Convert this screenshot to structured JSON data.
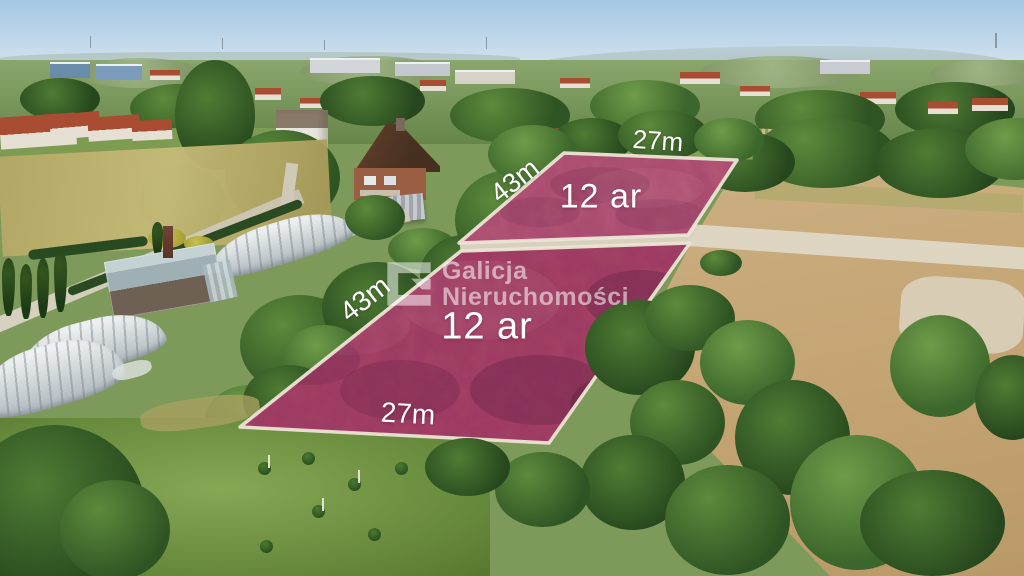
{
  "scene": {
    "description": "Aerial drone photo of two adjacent building plots for sale, highlighted in raspberry-pink with white survey borders, set in a suburban landscape with houses, greenhouses, trees and dry stubble fields",
    "language": "pl"
  },
  "plots": [
    {
      "id": "upper",
      "area_label": "12 ar",
      "front_label": "27m",
      "side_label": "43m"
    },
    {
      "id": "lower",
      "area_label": "12 ar",
      "front_label": "27m",
      "side_label": "43m"
    }
  ],
  "watermark": {
    "logo": "galicja-g-logo",
    "line1": "Galicja",
    "line2": "Nieruchomości"
  },
  "colors": {
    "plot_fill": "#a94467",
    "plot_fill_light": "#b85a79",
    "plot_border": "#ece5d4",
    "plot_divider": "#d8d1c0",
    "label_text": "#ffffff",
    "watermark_text": "rgba(255,255,255,0.55)",
    "sky_top": "#a4c8e3",
    "sky_horizon": "#dde8f0",
    "field_tan": "#c9a876",
    "field_path": "#e0d9c8",
    "lawn_green": "#6f9242",
    "roof_red": "#a84c32",
    "roof_brown": "#4a3020",
    "wall_brick": "#9a5f43",
    "greenhouse_white": "#e7eaea",
    "road_dirt": "#d3ccba",
    "meadow_dry": "#b5a765"
  }
}
